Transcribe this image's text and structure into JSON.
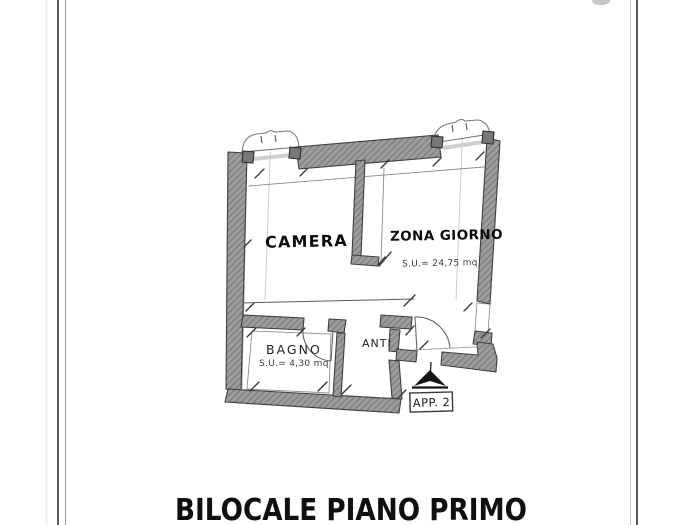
{
  "document": {
    "title": "BILOCALE PIANO PRIMO",
    "apartment_badge": "APP. 2"
  },
  "floorplan": {
    "rooms": {
      "camera": {
        "label": "CAMERA"
      },
      "zona_giorno": {
        "label": "ZONA GIORNO",
        "area": "S.U.= 24,75 mq"
      },
      "bagno": {
        "label": "BAGNO",
        "area": "S.U.= 4,30 mq"
      },
      "anti": {
        "label": "ANTI"
      }
    }
  },
  "colors": {
    "wall_fill": "#9c9c9c",
    "wall_outline": "#3f3f3f",
    "label_text": "#111111"
  }
}
